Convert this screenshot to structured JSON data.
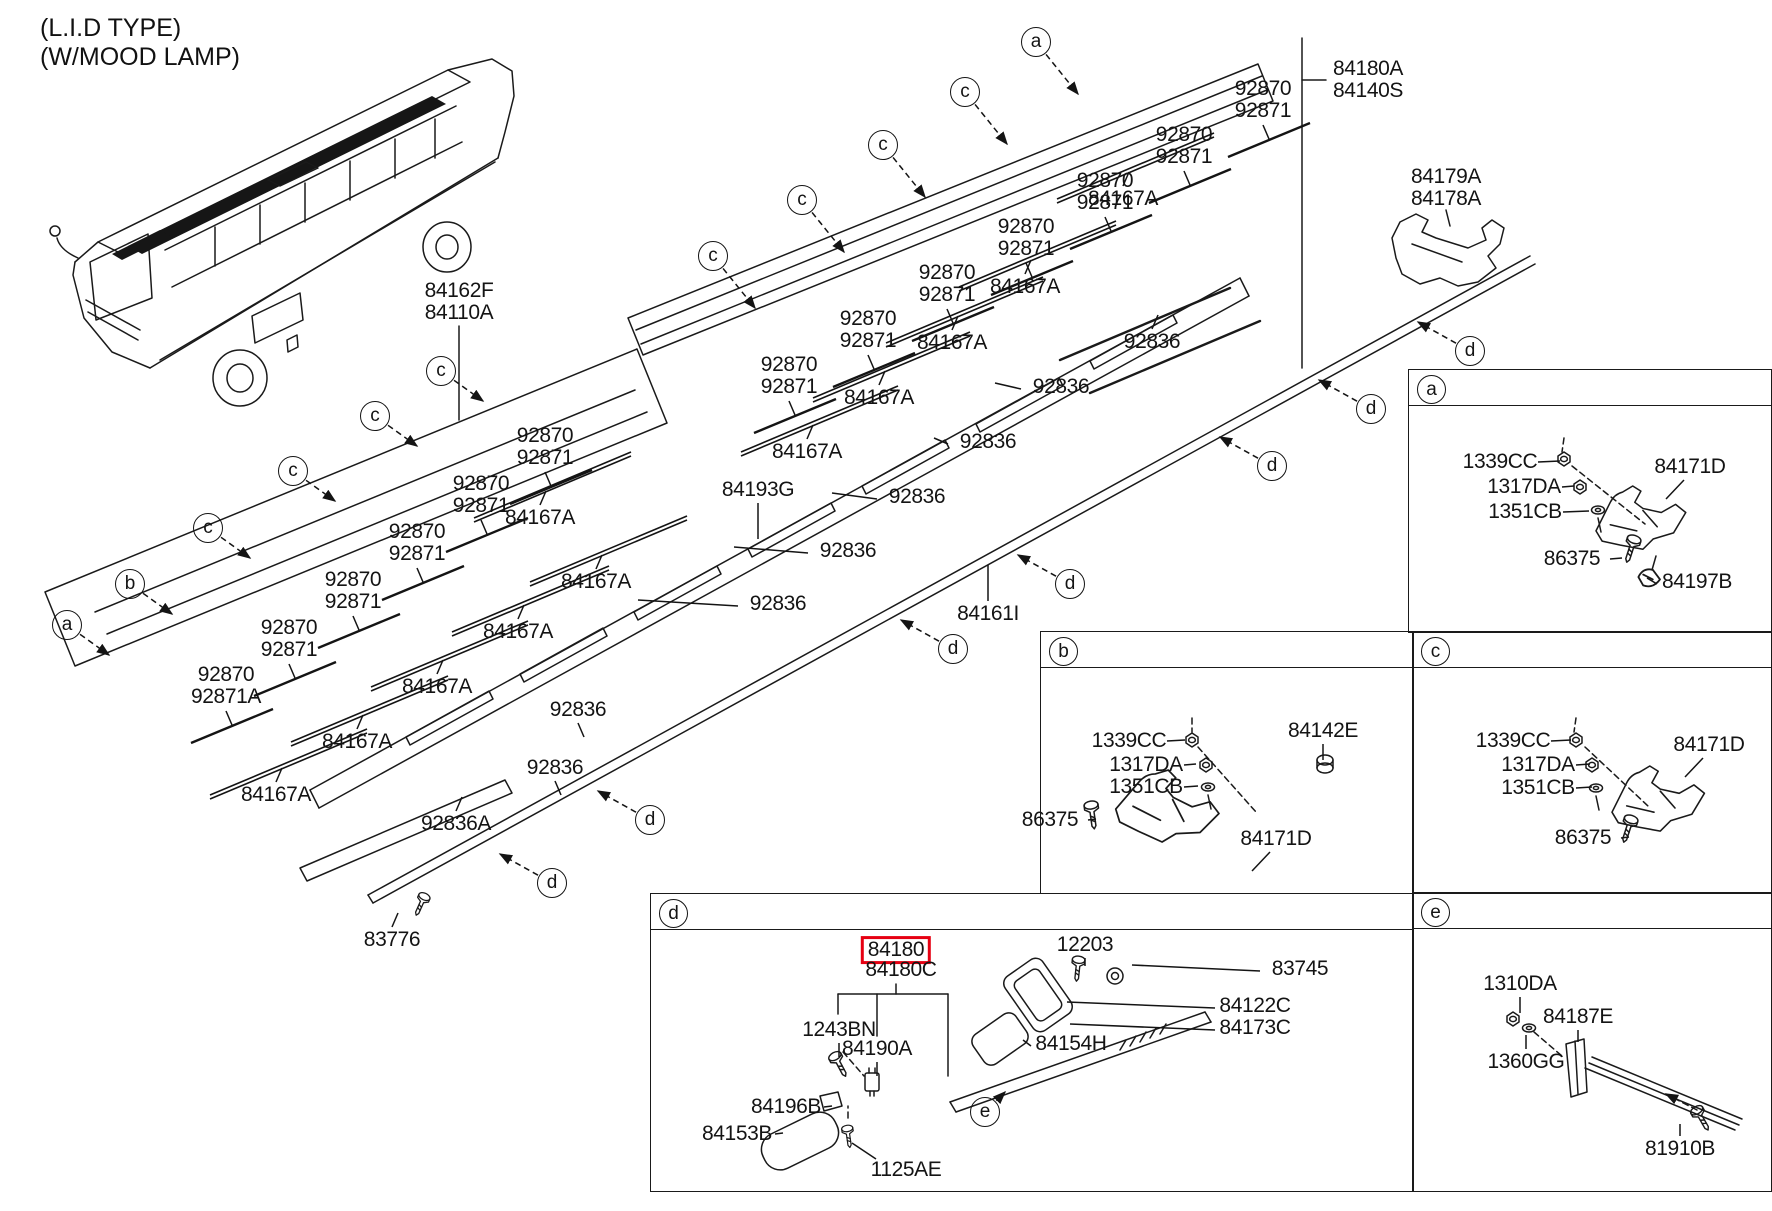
{
  "header": {
    "line1": "(L.I.D TYPE)",
    "line2": "(W/MOOD LAMP)"
  },
  "highlight_color": "#e60012",
  "selected_part": "84180",
  "part_labels": [
    {
      "t": "84162F\n84110A",
      "x": 459,
      "y": 302
    },
    {
      "t": "84180A\n84140S",
      "x": 1368,
      "y": 80
    },
    {
      "t": "84179A\n84178A",
      "x": 1446,
      "y": 188
    },
    {
      "t": "92870\n92871",
      "x": 1263,
      "y": 100,
      "k": "pair"
    },
    {
      "t": "92870\n92871",
      "x": 1184,
      "y": 146,
      "k": "pair"
    },
    {
      "t": "92870\n92871",
      "x": 1105,
      "y": 192,
      "k": "pair"
    },
    {
      "t": "92870\n92871",
      "x": 1026,
      "y": 238,
      "k": "pair"
    },
    {
      "t": "92870\n92871",
      "x": 947,
      "y": 284,
      "k": "pair"
    },
    {
      "t": "92870\n92871",
      "x": 868,
      "y": 330,
      "k": "pair"
    },
    {
      "t": "92870\n92871",
      "x": 789,
      "y": 376,
      "k": "pair"
    },
    {
      "t": "92870\n92871",
      "x": 545,
      "y": 447,
      "k": "pair"
    },
    {
      "t": "92870\n92871",
      "x": 481,
      "y": 495,
      "k": "pair"
    },
    {
      "t": "92870\n92871",
      "x": 417,
      "y": 543,
      "k": "pair"
    },
    {
      "t": "92870\n92871",
      "x": 353,
      "y": 591,
      "k": "pair"
    },
    {
      "t": "92870\n92871",
      "x": 289,
      "y": 639,
      "k": "pair"
    },
    {
      "t": "92870\n92871A",
      "x": 226,
      "y": 686,
      "k": "pair"
    },
    {
      "t": "84167A",
      "x": 1123,
      "y": 199,
      "k": "bar"
    },
    {
      "t": "84167A",
      "x": 1025,
      "y": 287,
      "k": "bar"
    },
    {
      "t": "84167A",
      "x": 952,
      "y": 343,
      "k": "bar"
    },
    {
      "t": "84167A",
      "x": 879,
      "y": 398,
      "k": "bar"
    },
    {
      "t": "84167A",
      "x": 807,
      "y": 452,
      "k": "bar"
    },
    {
      "t": "84167A",
      "x": 540,
      "y": 518,
      "k": "bar"
    },
    {
      "t": "84167A",
      "x": 596,
      "y": 582,
      "k": "bar"
    },
    {
      "t": "84167A",
      "x": 518,
      "y": 632,
      "k": "bar"
    },
    {
      "t": "84167A",
      "x": 437,
      "y": 687,
      "k": "bar"
    },
    {
      "t": "84167A",
      "x": 357,
      "y": 742,
      "k": "bar"
    },
    {
      "t": "84167A",
      "x": 276,
      "y": 795,
      "k": "bar"
    },
    {
      "t": "92836",
      "x": 1152,
      "y": 342,
      "ld": "u"
    },
    {
      "t": "92836",
      "x": 1061,
      "y": 387,
      "ld": "l",
      "ln": 26
    },
    {
      "t": "92836",
      "x": 988,
      "y": 442,
      "ld": "l",
      "ln": 14
    },
    {
      "t": "92836",
      "x": 917,
      "y": 497,
      "ld": "l",
      "ln": 45
    },
    {
      "t": "92836",
      "x": 848,
      "y": 551,
      "ld": "l",
      "ln": 74
    },
    {
      "t": "92836",
      "x": 778,
      "y": 604,
      "ld": "l",
      "ln": 100
    },
    {
      "t": "92836",
      "x": 578,
      "y": 710,
      "ld": "d"
    },
    {
      "t": "92836",
      "x": 555,
      "y": 768,
      "ld": "d"
    },
    {
      "t": "92836A",
      "x": 456,
      "y": 824,
      "ld": "u"
    },
    {
      "t": "84193G",
      "x": 758,
      "y": 490,
      "ld": "v",
      "ln": 36
    },
    {
      "t": "84161I",
      "x": 988,
      "y": 614,
      "ld": "^",
      "ln": 36
    },
    {
      "t": "83776",
      "x": 392,
      "y": 940,
      "ld": "u"
    },
    {
      "t": "1339CC",
      "x": 1500,
      "y": 462,
      "ld": "r",
      "ln": 22
    },
    {
      "t": "1317DA",
      "x": 1524,
      "y": 487,
      "ld": "r",
      "ln": 12
    },
    {
      "t": "1351CB",
      "x": 1525,
      "y": 512,
      "ld": "r",
      "ln": 26
    },
    {
      "t": "86375",
      "x": 1572,
      "y": 559,
      "ld": "r",
      "ln": 12
    },
    {
      "t": "84171D",
      "x": 1690,
      "y": 467,
      "ld": "q"
    },
    {
      "t": "84197B",
      "x": 1697,
      "y": 582,
      "ld": "l",
      "ln": 10
    },
    {
      "t": "1339CC",
      "x": 1129,
      "y": 741,
      "ld": "r",
      "ln": 18
    },
    {
      "t": "1317DA",
      "x": 1146,
      "y": 765,
      "ld": "r",
      "ln": 12
    },
    {
      "t": "1351CB",
      "x": 1146,
      "y": 787,
      "ld": "r",
      "ln": 14
    },
    {
      "t": "84142E",
      "x": 1323,
      "y": 731,
      "ld": "v",
      "ln": 16
    },
    {
      "t": "86375",
      "x": 1050,
      "y": 820,
      "ld": "r",
      "ln": 8
    },
    {
      "t": "84171D",
      "x": 1276,
      "y": 839,
      "ld": "q"
    },
    {
      "t": "1339CC",
      "x": 1513,
      "y": 741,
      "ld": "r",
      "ln": 20
    },
    {
      "t": "1317DA",
      "x": 1538,
      "y": 765,
      "ld": "r",
      "ln": 14
    },
    {
      "t": "1351CB",
      "x": 1538,
      "y": 788,
      "ld": "r",
      "ln": 16
    },
    {
      "t": "84171D",
      "x": 1709,
      "y": 745,
      "ld": "q"
    },
    {
      "t": "86375",
      "x": 1583,
      "y": 838,
      "ld": "r",
      "ln": 8
    },
    {
      "t": "84180",
      "x": 896,
      "y": 950,
      "red": true
    },
    {
      "t": "84180C",
      "x": 901,
      "y": 970
    },
    {
      "t": "12203",
      "x": 1085,
      "y": 945,
      "ld": "v",
      "ln": 8
    },
    {
      "t": "83745",
      "x": 1300,
      "y": 969,
      "ld": "l",
      "ln": 128
    },
    {
      "t": "84122C",
      "x": 1255,
      "y": 1006,
      "ld": "l",
      "ln": 148
    },
    {
      "t": "84173C",
      "x": 1255,
      "y": 1028,
      "ld": "l",
      "ln": 145
    },
    {
      "t": "84154H",
      "x": 1071,
      "y": 1044,
      "ld": "l",
      "ln": 8
    },
    {
      "t": "1243BN",
      "x": 839,
      "y": 1030,
      "ld": "v",
      "ln": 14
    },
    {
      "t": "84190A",
      "x": 877,
      "y": 1049,
      "ld": "v",
      "ln": 14
    },
    {
      "t": "84196B",
      "x": 786,
      "y": 1107,
      "ld": "r",
      "ln": 8
    },
    {
      "t": "84153B",
      "x": 737,
      "y": 1134,
      "ld": "r",
      "ln": 8
    },
    {
      "t": "1125AE",
      "x": 906,
      "y": 1170,
      "ld": "p"
    },
    {
      "t": "1310DA",
      "x": 1520,
      "y": 984,
      "ld": "v",
      "ln": 16
    },
    {
      "t": "84187E",
      "x": 1578,
      "y": 1017,
      "ld": "v",
      "ln": 12
    },
    {
      "t": "1360GG",
      "x": 1526,
      "y": 1062,
      "ld": "^",
      "ln": 14
    },
    {
      "t": "81910B",
      "x": 1680,
      "y": 1149,
      "ld": "^",
      "ln": 12
    }
  ],
  "callouts": [
    {
      "l": "a",
      "x": 1036,
      "y": 42,
      "tx": 1078,
      "ty": 94
    },
    {
      "l": "c",
      "x": 965,
      "y": 92,
      "tx": 1007,
      "ty": 144
    },
    {
      "l": "c",
      "x": 883,
      "y": 145,
      "tx": 925,
      "ty": 197
    },
    {
      "l": "c",
      "x": 802,
      "y": 200,
      "tx": 844,
      "ty": 252
    },
    {
      "l": "c",
      "x": 713,
      "y": 256,
      "tx": 755,
      "ty": 308
    },
    {
      "l": "c",
      "x": 441,
      "y": 371,
      "tx": 483,
      "ty": 401
    },
    {
      "l": "c",
      "x": 375,
      "y": 416,
      "tx": 417,
      "ty": 446
    },
    {
      "l": "c",
      "x": 293,
      "y": 471,
      "tx": 335,
      "ty": 501
    },
    {
      "l": "c",
      "x": 208,
      "y": 528,
      "tx": 250,
      "ty": 558
    },
    {
      "l": "b",
      "x": 130,
      "y": 584,
      "tx": 172,
      "ty": 614
    },
    {
      "l": "a",
      "x": 67,
      "y": 625,
      "tx": 109,
      "ty": 655
    },
    {
      "l": "d",
      "x": 1470,
      "y": 351,
      "tx": 1418,
      "ty": 322
    },
    {
      "l": "d",
      "x": 1371,
      "y": 409,
      "tx": 1319,
      "ty": 380
    },
    {
      "l": "d",
      "x": 1272,
      "y": 466,
      "tx": 1220,
      "ty": 437
    },
    {
      "l": "d",
      "x": 1070,
      "y": 584,
      "tx": 1018,
      "ty": 555
    },
    {
      "l": "d",
      "x": 953,
      "y": 649,
      "tx": 901,
      "ty": 620
    },
    {
      "l": "d",
      "x": 650,
      "y": 820,
      "tx": 598,
      "ty": 791
    },
    {
      "l": "d",
      "x": 552,
      "y": 883,
      "tx": 500,
      "ty": 854
    },
    {
      "l": "e",
      "x": 985,
      "y": 1112,
      "tx": 1005,
      "ty": 1092
    }
  ],
  "detail_boxes": [
    {
      "letter": "a",
      "x": 1408,
      "y": 369,
      "w": 362,
      "h": 262
    },
    {
      "letter": "b",
      "x": 1040,
      "y": 631,
      "w": 372,
      "h": 261
    },
    {
      "letter": "c",
      "x": 1412,
      "y": 631,
      "w": 358,
      "h": 261
    },
    {
      "letter": "d",
      "x": 650,
      "y": 893,
      "w": 762,
      "h": 297
    },
    {
      "letter": "e",
      "x": 1412,
      "y": 892,
      "w": 358,
      "h": 298
    }
  ]
}
